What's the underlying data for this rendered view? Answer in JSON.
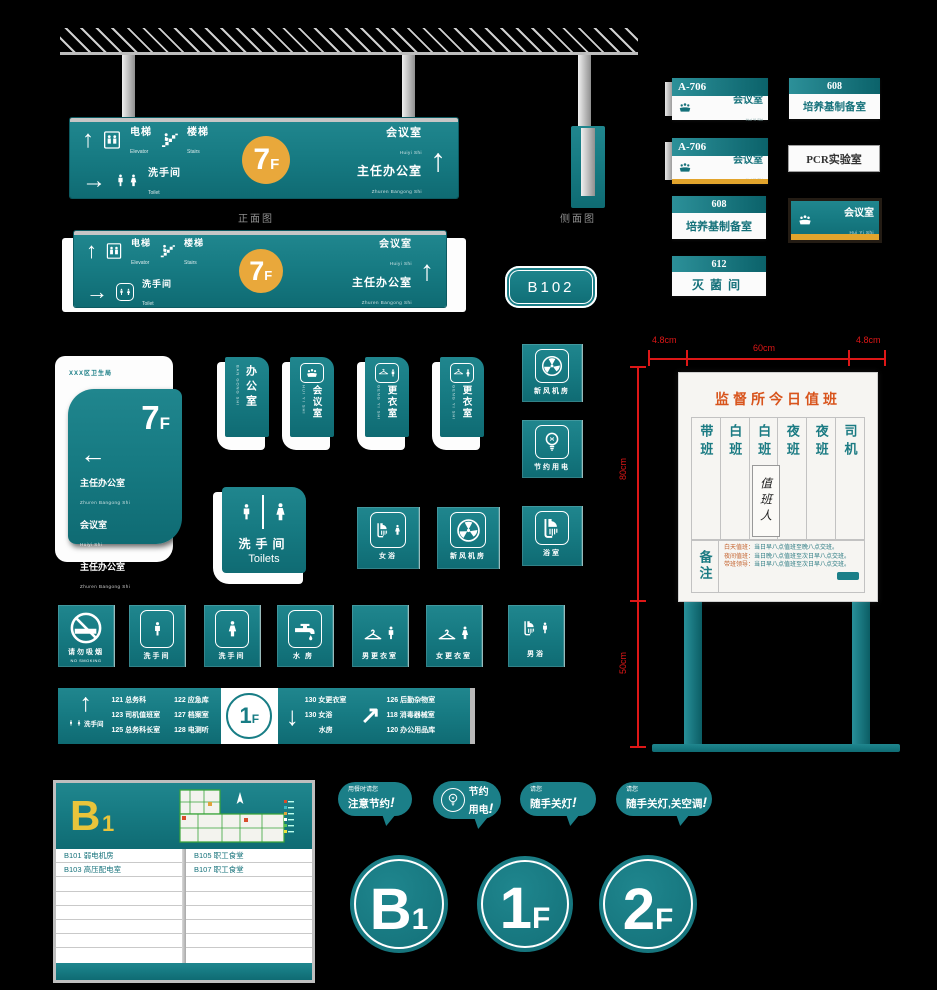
{
  "colors": {
    "teal": "#187d85",
    "teal_dark": "#0f6b73",
    "yellow": "#e9a83b",
    "orange_title": "#d8541c",
    "dim_red": "#de1717",
    "silver": "#c6c6c6",
    "background": "#000000"
  },
  "glyphs": {
    "up": "↑",
    "right": "→",
    "down": "↓",
    "up_right": "↗",
    "left": "←",
    "bang": "!"
  },
  "icons": [
    "elevator-icon",
    "stairs-icon",
    "male-icon",
    "female-icon",
    "meeting-icon",
    "hanger-icon",
    "fan-icon",
    "bulb-icon",
    "shower-icon",
    "faucet-icon",
    "no-smoking-icon",
    "north-arrow-icon"
  ],
  "views": {
    "front": "正面图",
    "side": "侧面图"
  },
  "overhead_sign": {
    "floor": "7",
    "floor_suffix": "F",
    "elevator_zh": "电梯",
    "elevator_en": "Elevator",
    "stairs_zh": "楼梯",
    "stairs_en": "Stairs",
    "toilet_zh": "洗手间",
    "toilet_en": "Toilet",
    "meeting_zh": "会议室",
    "meeting_py": "Huiyi Shi",
    "office_zh": "主任办公室",
    "office_py": "Zhuren Bangong Shi"
  },
  "room_badge": "B102",
  "plates": {
    "a706a": {
      "no": "A-706",
      "name": "会议室",
      "py": "Hui Yi Shi"
    },
    "a706b": {
      "no": "A-706",
      "name": "会议室",
      "py": "Hui Yi Shi"
    },
    "p608a": {
      "no": "608",
      "name": "培养基制备室"
    },
    "p612": {
      "no": "612",
      "name": "灭菌间"
    },
    "p608b": {
      "no": "608",
      "name": "培养基制备室"
    },
    "pcr": {
      "name": "PCR实验室"
    },
    "meeting": {
      "name": "会议室",
      "py": "Hui Yi Shi"
    }
  },
  "wall_sign": {
    "org": "XXX区卫生局",
    "floor": "7",
    "floor_suffix": "F",
    "items": [
      {
        "zh": "主任办公室",
        "py": "Zhuren Bangong Shi"
      },
      {
        "zh": "会议室",
        "py": "Huiyi Shi"
      },
      {
        "zh": "主任办公室",
        "py": "Zhuren Bangong Shi"
      }
    ]
  },
  "door_signs": [
    {
      "zh": "办公室",
      "py": "BAN GONG SHI"
    },
    {
      "zh": "会议室",
      "py": "HUI YI SHI"
    },
    {
      "zh": "更衣室",
      "py": "GENG YI SHI"
    },
    {
      "zh": "更衣室",
      "py": "GENG YI SHI"
    }
  ],
  "utility_signs": [
    {
      "label": "新风机房"
    },
    {
      "label": "节约用电"
    },
    {
      "label": "浴室"
    }
  ],
  "toilets_sign": {
    "zh": "洗手间",
    "en": "Toilets"
  },
  "mid_squares": [
    {
      "label": "女浴"
    },
    {
      "label": "新风机房"
    }
  ],
  "icon_row": [
    {
      "label": "请勿吸烟",
      "sub": "NO SMOKING"
    },
    {
      "label": "洗手间"
    },
    {
      "label": "洗手间"
    },
    {
      "label": "水房"
    },
    {
      "label": "男更衣室"
    },
    {
      "label": "女更衣室"
    },
    {
      "label": "男浴"
    }
  ],
  "directory_1f": {
    "floor": "1",
    "floor_suffix": "F",
    "near_label": "洗手间",
    "col1": [
      "121 总务科",
      "123 司机值班室",
      "125 总务科长室"
    ],
    "col2": [
      "122 应急库",
      "127 档案室",
      "128 电测听"
    ],
    "col3": [
      "130 女更衣室",
      "130 女浴",
      "水房"
    ],
    "col4": [
      "126 后勤杂物室",
      "118 消毒器械室",
      "120 办公用品库"
    ]
  },
  "duty_board": {
    "dim_top_left": "4.8cm",
    "dim_top_center": "60cm",
    "dim_top_right": "4.8cm",
    "dim_side_upper": "80cm",
    "dim_side_lower": "50cm",
    "title": "监督所今日值班",
    "columns": [
      "带班",
      "白班",
      "白班",
      "夜班",
      "夜班",
      "司机"
    ],
    "middle_label": "值班人",
    "note_label": "备注",
    "notes": [
      {
        "label": "白天值班：",
        "text": "当日早八点值班至晚八点交班。"
      },
      {
        "label": "夜间值班：",
        "text": "当日晚八点值班至次日早八点交班。"
      },
      {
        "label": "带班领导：",
        "text": "当日早八点值班至次日早八点交班。"
      }
    ]
  },
  "b1_directory": {
    "floor": "B",
    "floor_sub": "1",
    "left_rows": [
      "B101  弱电机房",
      "B103  高压配电室"
    ],
    "right_rows": [
      "B105  职工食堂",
      "B107  职工食堂"
    ]
  },
  "bubbles": [
    {
      "small": "用餐时请您",
      "big": "注意节约"
    },
    {
      "line1": "节约",
      "line2": "用电"
    },
    {
      "small": "请您",
      "big": "随手关灯"
    },
    {
      "small": "请您",
      "big": "随手关灯,关空调"
    }
  ],
  "floor_circles": [
    {
      "main": "B",
      "sub": "1"
    },
    {
      "main": "1",
      "sub": "F"
    },
    {
      "main": "2",
      "sub": "F"
    }
  ]
}
